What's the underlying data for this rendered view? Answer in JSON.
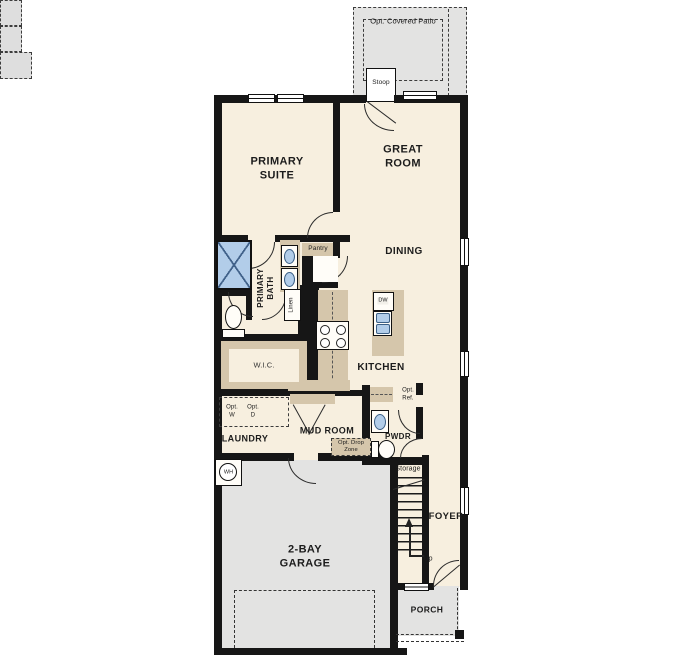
{
  "floorplan": {
    "labels": {
      "patio": "Opt. Covered Patio",
      "stoop": "Stoop",
      "primary_suite": "PRIMARY\nSUITE",
      "great_room": "GREAT\nROOM",
      "dining": "DINING",
      "kitchen": "KITCHEN",
      "primary_bath": "PRIMARY\nBATH",
      "pantry": "Pantry",
      "linen": "Linen",
      "wic": "W.I.C.",
      "laundry": "LAUNDRY",
      "opt_washer": "Opt.\nW",
      "opt_dryer": "Opt.\nD",
      "mud_room": "MUD ROOM",
      "drop_zone": "Opt. Drop\nZone",
      "pwdr": "PWDR",
      "opt_ref": "Opt.\nRef.",
      "storage": "Storage",
      "foyer": "FOYER",
      "up": "Up",
      "garage": "2-BAY\nGARAGE",
      "water_heater": "WH",
      "porch": "PORCH",
      "dishwasher": "DW"
    },
    "colors": {
      "floor": "#f7efdf",
      "wall": "#161616",
      "cabinet": "#d5c6ab",
      "concrete": "#e3e3e2",
      "fixture_blue": "#b2cde9",
      "optional_fill": "#dedede"
    },
    "fixtures": [
      "shower-icon",
      "vanity-sink-icon",
      "toilet-icon",
      "stove-icon",
      "dishwasher-icon",
      "kitchen-sink-icon",
      "water-heater-icon",
      "stairs-icon",
      "up-arrow-icon",
      "door-swing-icon",
      "window-icon",
      "optional-washer-box",
      "optional-dryer-box",
      "optional-refrigerator-box",
      "garage-door-outline",
      "drop-zone-box"
    ]
  }
}
